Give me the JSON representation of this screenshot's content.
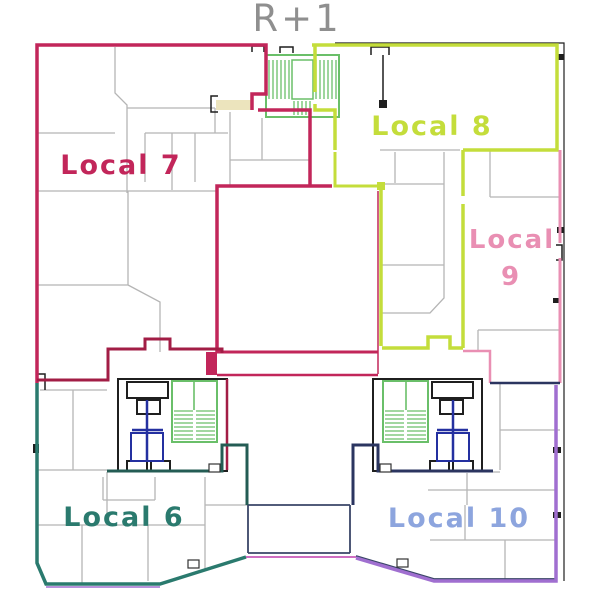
{
  "title": "R+1",
  "colors": {
    "background": "#ffffff",
    "title": "#8f8f8f",
    "wall_gray": "#b5b5b5",
    "wall_black": "#1f1f1f",
    "wall_dark": "#3a4668",
    "stair_green": "#6abf69",
    "elevator_navy": "#2430a0",
    "door_beige": "#ece4bd",
    "magenta": "#cf6ec2",
    "purple": "#a06fd0"
  },
  "regions": [
    {
      "id": "local-7",
      "label": "Local 7",
      "color": "#c2265a",
      "outline": [
        {
          "d": "M37,383 V45 H266 V94 H252 V110",
          "w": 3.5
        },
        {
          "d": "M258,110 H310 V186",
          "w": 3.5
        },
        {
          "d": "M332,186 H217 V352",
          "w": 3.5
        },
        {
          "d": "M217,352 H378",
          "w": 3
        },
        {
          "d": "M217,375 H378",
          "w": 2.5
        },
        {
          "d": "M37,380 H108 V349 H145 V339 H170 V349 H222 V353",
          "c": "#a21d45",
          "w": 3
        },
        {
          "d": "M227,379 V470",
          "c": "#a21d45",
          "w": 2.5
        },
        {
          "d": "M378,191 V374",
          "w": 1.5
        },
        {
          "d": "M206,352 h11 v23 h-11 Z",
          "fill": true
        }
      ]
    },
    {
      "id": "local-8",
      "label": "Local 8",
      "color": "#c4dd3b",
      "outline": [
        {
          "d": "M312,45 H557 V150 H463",
          "w": 3.5
        },
        {
          "d": "M463,150 V196 M463,204 V348",
          "w": 3.5
        },
        {
          "d": "M382,348 H428 V337 H450 V348 H463",
          "w": 3.5
        },
        {
          "d": "M315,45 V92 M315,104 V110 H335 V150",
          "w": 3.5
        },
        {
          "d": "M335,152 V186 H377",
          "w": 3
        },
        {
          "d": "M381,190 V346",
          "w": 3.5
        },
        {
          "d": "M377,182 h8 v8 h-8 Z",
          "fill": true
        }
      ]
    },
    {
      "id": "local-9",
      "label": "Local 9",
      "line1": "Local",
      "line2": "9",
      "color": "#e98fb3",
      "outline": [
        {
          "d": "M560,150 V243 M560,258 V383",
          "w": 3
        },
        {
          "d": "M463,351 H490 V383",
          "w": 2.5
        }
      ]
    },
    {
      "id": "local-6",
      "label": "Local 6",
      "color": "#2a7a6e",
      "outline": [
        {
          "d": "M37,383 V563 L46,584 H160 L246,557",
          "w": 3.5
        },
        {
          "d": "M107,471 H222 V445 H247 V505",
          "c": "#245c54",
          "w": 3
        }
      ]
    },
    {
      "id": "local-10",
      "label": "Local 10",
      "color": "#8da5de",
      "outline": [
        {
          "d": "M353,505 V445 H378 V471 H493",
          "c": "#2b3560",
          "w": 3
        },
        {
          "d": "M490,383 H560",
          "c": "#2b3560",
          "w": 2.5
        },
        {
          "d": "M356,558 L434,581 H556 V385",
          "c": "#a06fd0",
          "w": 3.5
        }
      ]
    }
  ]
}
